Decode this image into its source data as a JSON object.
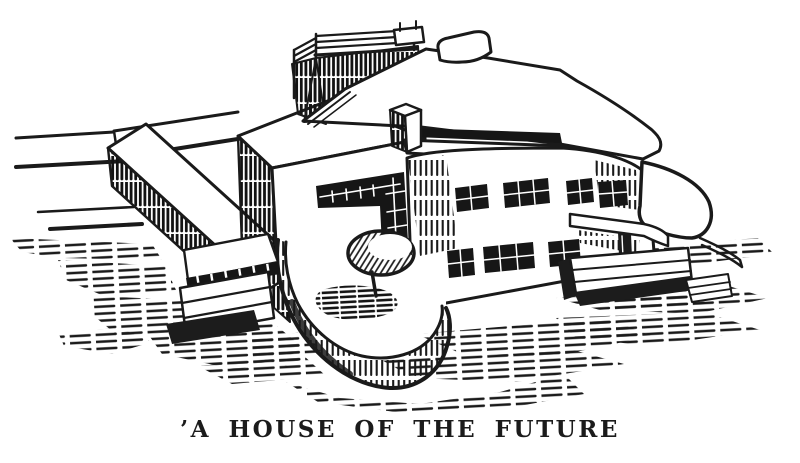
{
  "figure": {
    "alt": "Pen-and-ink perspective drawing of a white modernist flat-roofed house with a rooftop railed terrace, an L-shaped corner window, two rows of dark gridded windows, a rounded front terrace with a round umbrella table, a long low garden wall with steps on the left, a curved balcony with steps on the right, and heavy horizontal hatched ground shadows",
    "ink_color": "#1a1a1a",
    "paper_color": "#ffffff"
  },
  "caption": {
    "text": "’A HOUSE OF THE FUTURE"
  }
}
